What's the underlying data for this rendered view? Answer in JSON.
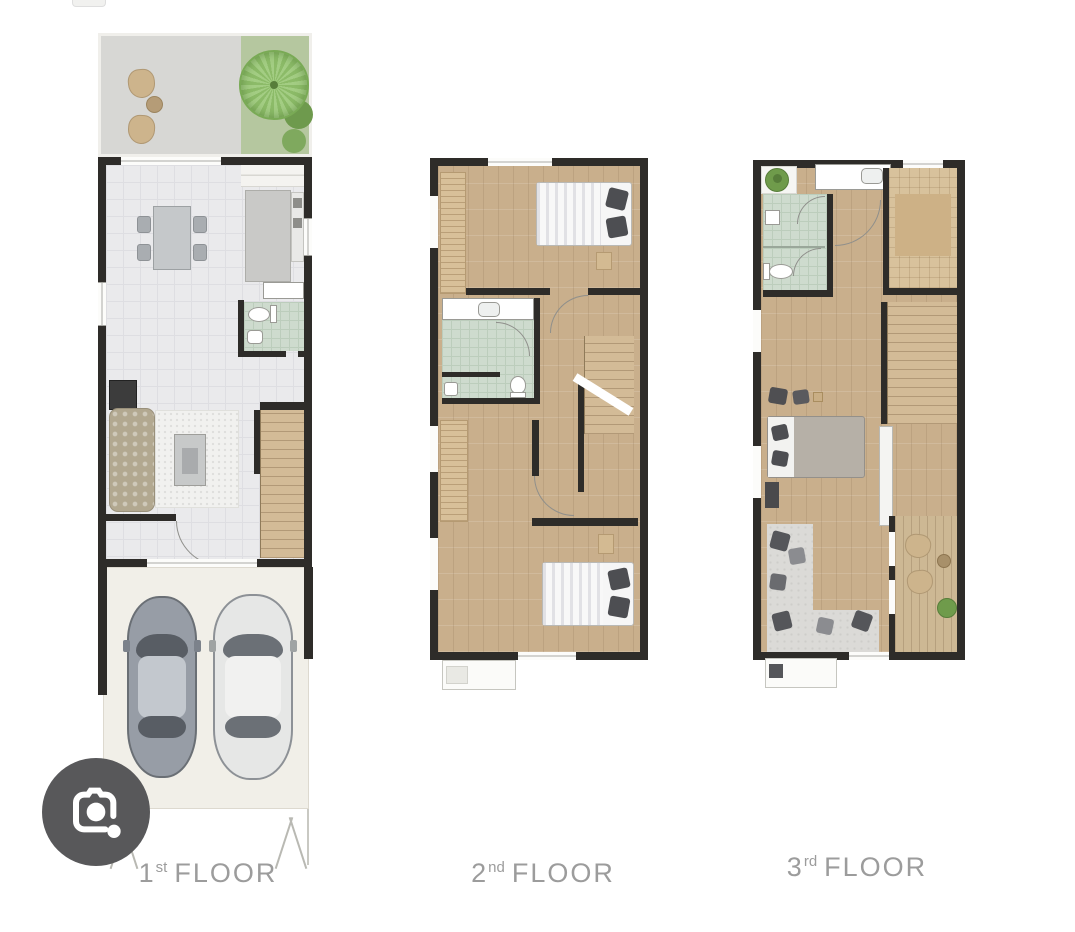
{
  "canvas": {
    "width": 1075,
    "height": 932,
    "background": "#ffffff"
  },
  "floors": [
    {
      "name": "first-floor",
      "label": {
        "number": "1",
        "ordinal": "st",
        "word": "FLOOR"
      },
      "features": [
        "patio-chairs",
        "garden-tree",
        "dining-table",
        "kitchen",
        "bathroom",
        "living-sofa",
        "stairs",
        "two-car-garage",
        "driveway"
      ]
    },
    {
      "name": "second-floor",
      "label": {
        "number": "2",
        "ordinal": "nd",
        "word": "FLOOR"
      },
      "features": [
        "bedroom-front",
        "wardrobes",
        "bathroom",
        "hall",
        "stairs",
        "bedroom-back",
        "balcony"
      ]
    },
    {
      "name": "third-floor",
      "label": {
        "number": "3",
        "ordinal": "rd",
        "word": "FLOOR"
      },
      "features": [
        "bathroom",
        "walk-in-closet",
        "master-bedroom",
        "stairs",
        "terrace",
        "balcony"
      ]
    }
  ],
  "icons": {
    "lens_button": "camera-lens-icon"
  },
  "colors": {
    "wall": "#2e2c29",
    "wood_floor": "#c9af8c",
    "tile_floor": "#eaeaec",
    "bath_floor": "#cedbce",
    "lawn": "#b5c79f",
    "tree": "#8cbb68",
    "patio": "#d7d7d4",
    "car_gray": "#979da6",
    "car_white": "#e6e7e6",
    "label_text": "#9c9c9c",
    "lens_background": "#58585a"
  }
}
